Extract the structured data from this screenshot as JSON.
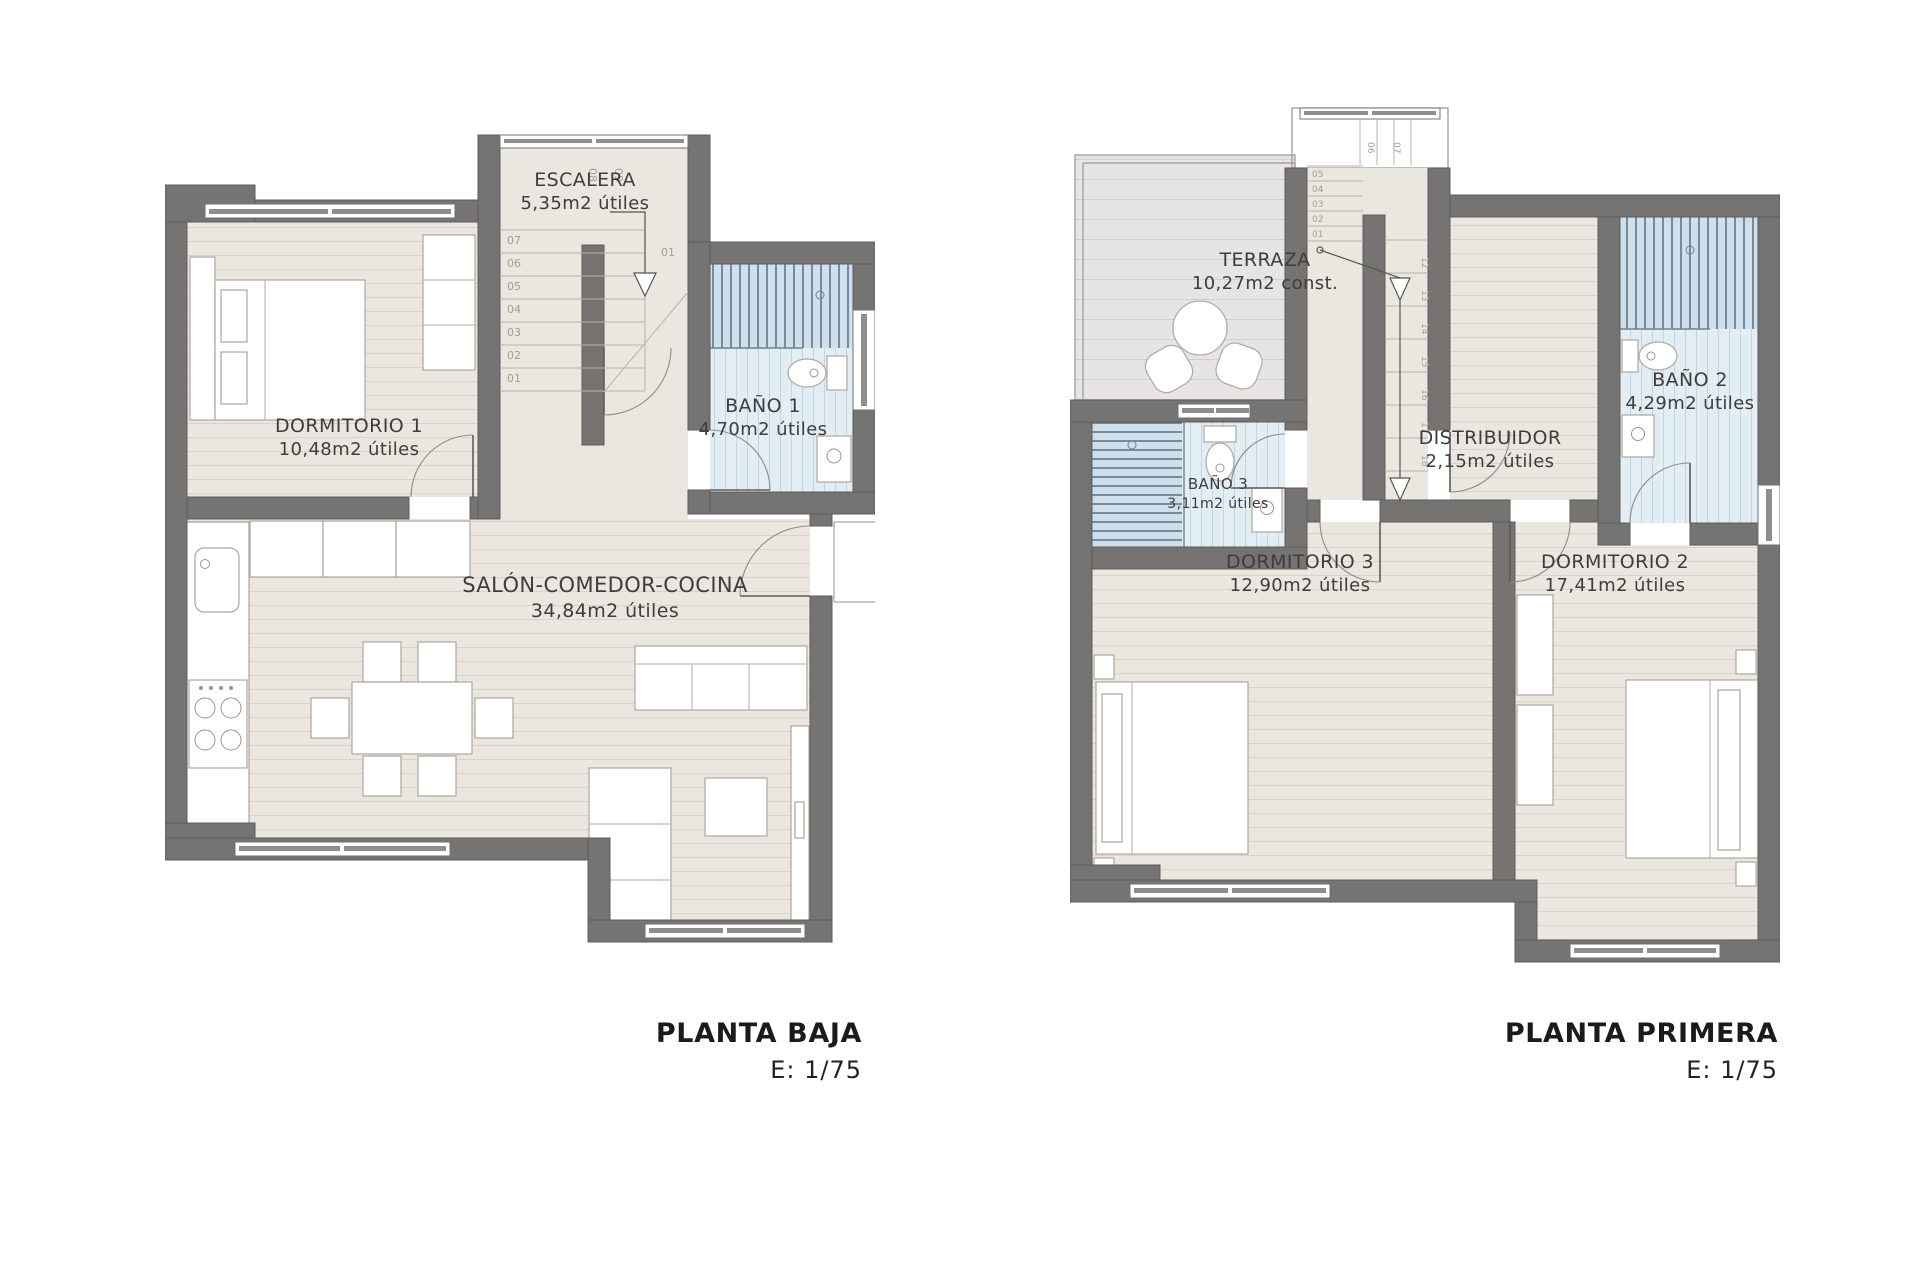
{
  "plans": {
    "ground": {
      "title": "PLANTA BAJA",
      "scale": "E: 1/75",
      "rooms": {
        "dormitorio1": {
          "name": "DORMITORIO 1",
          "area": "10,48m2 útiles"
        },
        "escalera": {
          "name": "ESCALERA",
          "area": "5,35m2 útiles"
        },
        "bano1": {
          "name": "BAÑO 1",
          "area": "4,70m2 útiles"
        },
        "salon": {
          "name": "SALÓN-COMEDOR-COCINA",
          "area": "34,84m2 útiles"
        }
      },
      "stair_numbers": {
        "run": [
          "01",
          "02",
          "03",
          "04",
          "05",
          "06",
          "07"
        ],
        "top": [
          "08",
          "09"
        ],
        "turn": "01"
      }
    },
    "first": {
      "title": "PLANTA PRIMERA",
      "scale": "E: 1/75",
      "rooms": {
        "terraza": {
          "name": "TERRAZA",
          "area": "10,27m2 const."
        },
        "bano2": {
          "name": "BAÑO 2",
          "area": "4,29m2 útiles"
        },
        "bano3": {
          "name": "BAÑO 3",
          "area": "3,11m2 útiles"
        },
        "distribuidor": {
          "name": "DISTRIBUIDOR",
          "area": "2,15m2 útiles"
        },
        "dormitorio3": {
          "name": "DORMITORIO 3",
          "area": "12,90m2 útiles"
        },
        "dormitorio2": {
          "name": "DORMITORIO 2",
          "area": "17,41m2 útiles"
        }
      },
      "stair_numbers": {
        "left": [
          "05",
          "04",
          "03",
          "02",
          "01"
        ],
        "right": [
          "12",
          "13",
          "14",
          "15",
          "16",
          "17",
          "18"
        ],
        "top": [
          "06",
          "07"
        ]
      }
    }
  },
  "colors": {
    "wall": "#767472",
    "floor_wood": "#ebe7e0",
    "floor_line": "#d9d3c9",
    "stair_floor": "#eae7e1",
    "terrace_floor": "#e6e5e3",
    "bath_tile": "#e3edf4",
    "bath_stripe": "#c3d5e2",
    "shower_tile": "#cfdfec",
    "shower_stripe": "#5d7787",
    "label_text": "#3d3d3d",
    "stair_number_text": "#a39e94",
    "title_text": "#1b1b1b"
  }
}
